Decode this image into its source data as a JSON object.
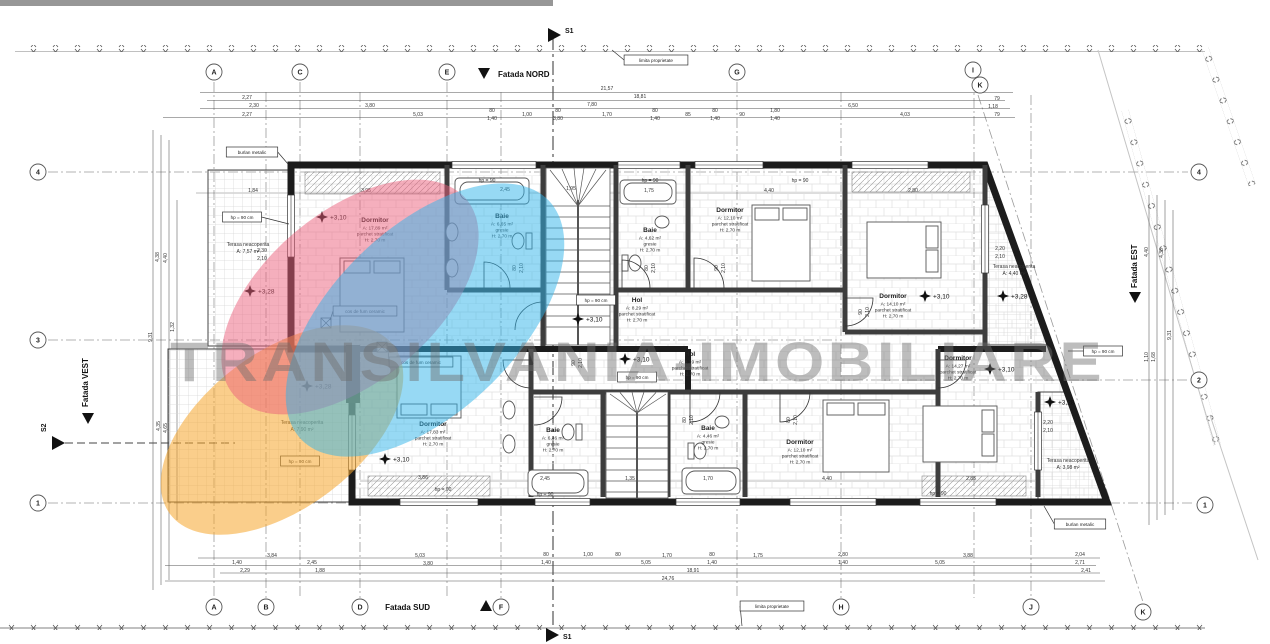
{
  "watermark": {
    "text": "TRANSILVANIA-IMOBILIARE",
    "color": "#6e6e6e"
  },
  "labels": {
    "fatada_nord": "Fatada NORD",
    "fatada_sud": "Fatada SUD",
    "fatada_vest": "Fatada VEST",
    "fatada_est": "Fatada EST",
    "s1_top": "S1",
    "s1_bottom": "S1",
    "s2": "S2"
  },
  "highlights": {
    "orange": "#F6A62B",
    "pink": "#EC5F7B",
    "blue": "#2FB4E9"
  },
  "rooms": [
    {
      "name": "Dormitor",
      "area": "A: 17,89 m²",
      "finish": "parchet stratificat",
      "height": "H: 2,70 m",
      "x": 375,
      "y": 222,
      "small": false
    },
    {
      "name": "Baie",
      "area": "A: 6,65 m²",
      "finish": "gresie",
      "height": "H: 2,70 m",
      "x": 502,
      "y": 218,
      "small": false
    },
    {
      "name": "Baie",
      "area": "A: 4,62 m²",
      "finish": "gresie",
      "height": "H: 2,70 m",
      "x": 650,
      "y": 232,
      "small": false
    },
    {
      "name": "Dormitor",
      "area": "A: 12,10 m²",
      "finish": "parchet stratificat",
      "height": "H: 2,70 m",
      "x": 730,
      "y": 212,
      "small": false
    },
    {
      "name": "Dormitor",
      "area": "A: 14,10 m²",
      "finish": "parchet stratificat",
      "height": "H: 2,70 m",
      "x": 893,
      "y": 298,
      "small": false
    },
    {
      "name": "Hol",
      "area": "A: 8,29 m²",
      "finish": "parchet stratificat",
      "height": "H: 2,70 m",
      "x": 637,
      "y": 302,
      "small": false
    },
    {
      "name": "Hol",
      "area": "A: 8,39 m²",
      "finish": "parchet stratificat",
      "height": "H: 2,70 m",
      "x": 690,
      "y": 356,
      "small": false
    },
    {
      "name": "Dormitor",
      "area": "A: 17,83 m²",
      "finish": "parchet stratificat",
      "height": "H: 2,70 m",
      "x": 433,
      "y": 426,
      "small": false
    },
    {
      "name": "Baie",
      "area": "A: 6,46 m²",
      "finish": "gresie",
      "height": "H: 2,70 m",
      "x": 553,
      "y": 432,
      "small": false
    },
    {
      "name": "Baie",
      "area": "A: 4,46 m²",
      "finish": "gresie",
      "height": "H: 2,70 m",
      "x": 708,
      "y": 430,
      "small": false
    },
    {
      "name": "Dormitor",
      "area": "A: 12,10 m²",
      "finish": "parchet stratificat",
      "height": "H: 2,70 m",
      "x": 800,
      "y": 444,
      "small": false
    },
    {
      "name": "Dormitor",
      "area": "A: 14,27 m²",
      "finish": "parchet stratificat",
      "height": "H: 2,70 m",
      "x": 958,
      "y": 360,
      "small": false
    },
    {
      "name": "Terasa neacoperita",
      "area": "A: 7,57 m²",
      "finish": "",
      "height": "",
      "x": 248,
      "y": 246,
      "small": true
    },
    {
      "name": "Terasa neacoperita",
      "area": "A: 7,90 m²",
      "finish": "",
      "height": "",
      "x": 302,
      "y": 424,
      "small": true
    },
    {
      "name": "Terasa neacoperita",
      "area": "A: 4,40 m²",
      "finish": "",
      "height": "",
      "x": 1014,
      "y": 268,
      "small": true
    },
    {
      "name": "Terasa neacoperita",
      "area": "A: 3,98 m²",
      "finish": "",
      "height": "",
      "x": 1068,
      "y": 462,
      "small": true
    }
  ],
  "markers": [
    {
      "t": "+3,10",
      "x": 322,
      "y": 217
    },
    {
      "t": "+3,28",
      "x": 250,
      "y": 291
    },
    {
      "t": "+3,28",
      "x": 307,
      "y": 386
    },
    {
      "t": "+3,10",
      "x": 578,
      "y": 319
    },
    {
      "t": "+3,10",
      "x": 625,
      "y": 359
    },
    {
      "t": "+3,10",
      "x": 925,
      "y": 296
    },
    {
      "t": "+3,28",
      "x": 1003,
      "y": 296
    },
    {
      "t": "+3,10",
      "x": 990,
      "y": 369
    },
    {
      "t": "+3,28",
      "x": 1050,
      "y": 402
    },
    {
      "t": "+3,10",
      "x": 385,
      "y": 459
    }
  ],
  "boxes": [
    {
      "t": "limita proprietate",
      "x": 656,
      "y": 60,
      "lx": 612,
      "ly": 50
    },
    {
      "t": "limita proprietate",
      "x": 772,
      "y": 606,
      "lx": 742,
      "ly": 626
    },
    {
      "t": "burlan metalic",
      "x": 252,
      "y": 152,
      "lx": 288,
      "ly": 164
    },
    {
      "t": "burlan metalic",
      "x": 1080,
      "y": 524,
      "lx": 1044,
      "ly": 506
    },
    {
      "t": "cos de fum ceramic",
      "x": 365,
      "y": 311,
      "lx": 330,
      "ly": 320
    },
    {
      "t": "cos de fum ceramic",
      "x": 421,
      "y": 362,
      "lx": 388,
      "ly": 350
    },
    {
      "t": "hp = 90 cm",
      "x": 242,
      "y": 217,
      "lx": 289,
      "ly": 224
    },
    {
      "t": "hp = 90 cm",
      "x": 596,
      "y": 300
    },
    {
      "t": "hp = 90 cm",
      "x": 637,
      "y": 377
    },
    {
      "t": "hp = 90 cm",
      "x": 300,
      "y": 461
    },
    {
      "t": "hp = 90 cm",
      "x": 1103,
      "y": 351,
      "lx": 1068,
      "ly": 351
    }
  ],
  "bubbles": [
    {
      "l": "A",
      "x": 214,
      "y": 72
    },
    {
      "l": "C",
      "x": 300,
      "y": 72
    },
    {
      "l": "E",
      "x": 447,
      "y": 72
    },
    {
      "l": "G",
      "x": 737,
      "y": 72
    },
    {
      "l": "I",
      "x": 973,
      "y": 70
    },
    {
      "l": "K",
      "x": 980,
      "y": 85
    },
    {
      "l": "A",
      "x": 214,
      "y": 607
    },
    {
      "l": "B",
      "x": 266,
      "y": 607
    },
    {
      "l": "D",
      "x": 360,
      "y": 607
    },
    {
      "l": "F",
      "x": 501,
      "y": 607
    },
    {
      "l": "H",
      "x": 841,
      "y": 607
    },
    {
      "l": "J",
      "x": 1031,
      "y": 607
    },
    {
      "l": "K",
      "x": 1143,
      "y": 612
    },
    {
      "l": "4",
      "x": 38,
      "y": 172
    },
    {
      "l": "3",
      "x": 38,
      "y": 340
    },
    {
      "l": "1",
      "x": 38,
      "y": 503
    },
    {
      "l": "4",
      "x": 1199,
      "y": 172
    },
    {
      "l": "2",
      "x": 1199,
      "y": 380
    },
    {
      "l": "1",
      "x": 1205,
      "y": 505
    }
  ],
  "dims": [
    {
      "t": "21,57",
      "x": 607,
      "y": 90
    },
    {
      "t": "18,81",
      "x": 640,
      "y": 98
    },
    {
      "t": "7,80",
      "x": 592,
      "y": 106
    },
    {
      "t": "2,27",
      "x": 247,
      "y": 99
    },
    {
      "t": "2,30",
      "x": 254,
      "y": 107
    },
    {
      "t": "3,80",
      "x": 370,
      "y": 107
    },
    {
      "t": "2,27",
      "x": 247,
      "y": 116
    },
    {
      "t": "5,03",
      "x": 418,
      "y": 116
    },
    {
      "t": "80",
      "x": 492,
      "y": 112
    },
    {
      "t": "1,40",
      "x": 492,
      "y": 120
    },
    {
      "t": "1,00",
      "x": 527,
      "y": 116
    },
    {
      "t": "80",
      "x": 558,
      "y": 112
    },
    {
      "t": "3,80",
      "x": 558,
      "y": 120
    },
    {
      "t": "1,70",
      "x": 607,
      "y": 116
    },
    {
      "t": "80",
      "x": 655,
      "y": 112
    },
    {
      "t": "1,40",
      "x": 655,
      "y": 120
    },
    {
      "t": "85",
      "x": 688,
      "y": 116
    },
    {
      "t": "80",
      "x": 715,
      "y": 112
    },
    {
      "t": "1,40",
      "x": 715,
      "y": 120
    },
    {
      "t": "90",
      "x": 742,
      "y": 116
    },
    {
      "t": "1,80",
      "x": 775,
      "y": 112
    },
    {
      "t": "1,40",
      "x": 775,
      "y": 120
    },
    {
      "t": "6,50",
      "x": 853,
      "y": 107
    },
    {
      "t": "4,03",
      "x": 905,
      "y": 116
    },
    {
      "t": "79",
      "x": 997,
      "y": 100
    },
    {
      "t": "1,18",
      "x": 993,
      "y": 108
    },
    {
      "t": "79",
      "x": 997,
      "y": 116
    },
    {
      "t": "1,84",
      "x": 253,
      "y": 192
    },
    {
      "t": "3,95",
      "x": 366,
      "y": 192
    },
    {
      "t": "2,45",
      "x": 505,
      "y": 191
    },
    {
      "t": "1,95",
      "x": 571,
      "y": 190
    },
    {
      "t": "1,75",
      "x": 649,
      "y": 192
    },
    {
      "t": "4,40",
      "x": 769,
      "y": 192
    },
    {
      "t": "2,80",
      "x": 913,
      "y": 192
    },
    {
      "t": "hp = 90",
      "x": 487,
      "y": 182
    },
    {
      "t": "hp = 90",
      "x": 650,
      "y": 182
    },
    {
      "t": "hp = 90",
      "x": 800,
      "y": 182
    },
    {
      "t": "3,86",
      "x": 423,
      "y": 479
    },
    {
      "t": "2,45",
      "x": 545,
      "y": 480
    },
    {
      "t": "1,35",
      "x": 630,
      "y": 480
    },
    {
      "t": "1,70",
      "x": 708,
      "y": 480
    },
    {
      "t": "4,40",
      "x": 827,
      "y": 480
    },
    {
      "t": "2,85",
      "x": 971,
      "y": 480
    },
    {
      "t": "hp = 90",
      "x": 443,
      "y": 491
    },
    {
      "t": "hp = 90",
      "x": 545,
      "y": 496
    },
    {
      "t": "hp = 90",
      "x": 938,
      "y": 495
    },
    {
      "t": "2,30",
      "x": 262,
      "y": 252
    },
    {
      "t": "2,10",
      "x": 262,
      "y": 260
    },
    {
      "t": "2,20",
      "x": 1000,
      "y": 250
    },
    {
      "t": "2,10",
      "x": 1000,
      "y": 258
    },
    {
      "t": "2,20",
      "x": 1048,
      "y": 424
    },
    {
      "t": "2,10",
      "x": 1048,
      "y": 432
    },
    {
      "t": "3,84",
      "x": 272,
      "y": 557
    },
    {
      "t": "1,40",
      "x": 237,
      "y": 564
    },
    {
      "t": "2,45",
      "x": 312,
      "y": 564
    },
    {
      "t": "5,03",
      "x": 420,
      "y": 557
    },
    {
      "t": "3,80",
      "x": 428,
      "y": 565
    },
    {
      "t": "80",
      "x": 546,
      "y": 556
    },
    {
      "t": "1,40",
      "x": 546,
      "y": 564
    },
    {
      "t": "1,00",
      "x": 588,
      "y": 556
    },
    {
      "t": "2,29",
      "x": 245,
      "y": 572
    },
    {
      "t": "1,88",
      "x": 320,
      "y": 572
    },
    {
      "t": "80",
      "x": 618,
      "y": 556
    },
    {
      "t": "1,70",
      "x": 667,
      "y": 557
    },
    {
      "t": "80",
      "x": 712,
      "y": 556
    },
    {
      "t": "1,40",
      "x": 712,
      "y": 564
    },
    {
      "t": "1,75",
      "x": 758,
      "y": 557
    },
    {
      "t": "2,80",
      "x": 843,
      "y": 556
    },
    {
      "t": "1,40",
      "x": 843,
      "y": 564
    },
    {
      "t": "5,05",
      "x": 646,
      "y": 564
    },
    {
      "t": "5,05",
      "x": 940,
      "y": 564
    },
    {
      "t": "3,88",
      "x": 968,
      "y": 557
    },
    {
      "t": "18,91",
      "x": 693,
      "y": 572
    },
    {
      "t": "24,76",
      "x": 668,
      "y": 580
    },
    {
      "t": "2,04",
      "x": 1080,
      "y": 556
    },
    {
      "t": "2,71",
      "x": 1080,
      "y": 564
    },
    {
      "t": "2,41",
      "x": 1086,
      "y": 572
    }
  ],
  "dims_rot": [
    {
      "t": "4,38",
      "x": 159,
      "y": 257
    },
    {
      "t": "4,40",
      "x": 167,
      "y": 258
    },
    {
      "t": "1,32",
      "x": 174,
      "y": 327
    },
    {
      "t": "9,31",
      "x": 152,
      "y": 337
    },
    {
      "t": "4,35",
      "x": 160,
      "y": 426
    },
    {
      "t": "4,65",
      "x": 167,
      "y": 428
    },
    {
      "t": "4,40",
      "x": 1148,
      "y": 252
    },
    {
      "t": "4,38",
      "x": 1163,
      "y": 253
    },
    {
      "t": "9,31",
      "x": 1171,
      "y": 335
    },
    {
      "t": "1,10",
      "x": 1148,
      "y": 357
    },
    {
      "t": "1,68",
      "x": 1155,
      "y": 357
    },
    {
      "t": "80",
      "x": 516,
      "y": 268
    },
    {
      "t": "2,10",
      "x": 523,
      "y": 268
    },
    {
      "t": "80",
      "x": 648,
      "y": 268
    },
    {
      "t": "2,10",
      "x": 655,
      "y": 268
    },
    {
      "t": "90",
      "x": 718,
      "y": 268
    },
    {
      "t": "2,10",
      "x": 725,
      "y": 268
    },
    {
      "t": "90",
      "x": 862,
      "y": 312
    },
    {
      "t": "2,10",
      "x": 869,
      "y": 312
    },
    {
      "t": "90",
      "x": 575,
      "y": 363
    },
    {
      "t": "2,10",
      "x": 582,
      "y": 363
    },
    {
      "t": "80",
      "x": 686,
      "y": 420
    },
    {
      "t": "2,10",
      "x": 693,
      "y": 420
    },
    {
      "t": "80",
      "x": 790,
      "y": 420
    },
    {
      "t": "2,10",
      "x": 797,
      "y": 420
    }
  ]
}
